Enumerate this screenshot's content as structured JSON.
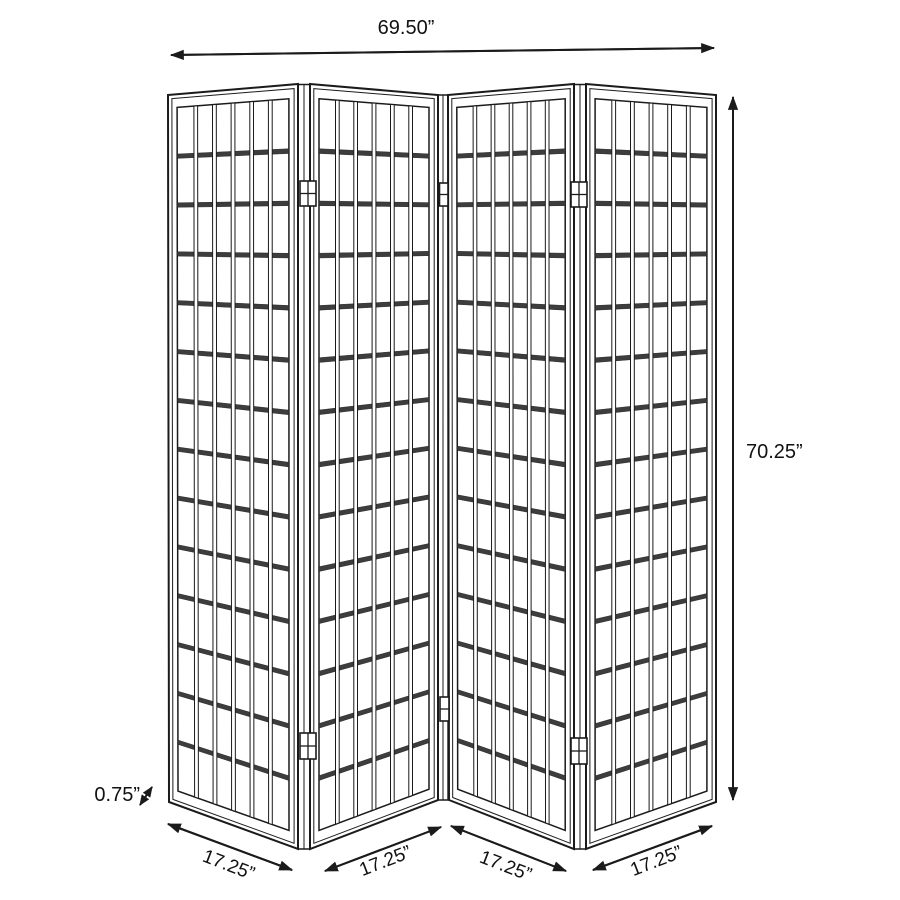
{
  "figure": {
    "type": "product-dimension-diagram",
    "subject": "4-panel folding room divider screen with lattice grid panels",
    "colors": {
      "background": "#ffffff",
      "line": "#1b1b1b",
      "rail_fill": "#3d3d3d",
      "panel_fill": "#ffffff"
    },
    "labels": {
      "overall_width": "69.50”",
      "overall_height": "70.25”",
      "panel_thickness": "0.75”",
      "panel_width_1": "17.25”",
      "panel_width_2": "17.25”",
      "panel_width_3": "17.25”",
      "panel_width_4": "17.25”"
    },
    "panels": {
      "count": 4,
      "columns_per_panel": 6,
      "rows_per_panel": 14,
      "hinge_pairs": 3
    }
  }
}
